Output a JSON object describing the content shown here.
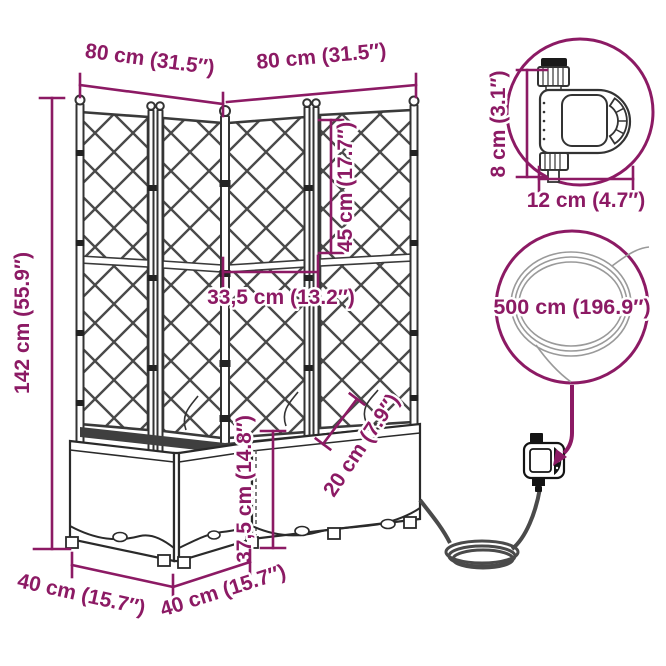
{
  "title": "Garden planter with trellis and automatic watering set — dimension diagram",
  "colors": {
    "accent": "#8C1A64",
    "line_art": "#2a2a2a",
    "hose": "#4a4a4a",
    "background": "#ffffff"
  },
  "dimensions": {
    "left_width": "80 cm (31.5″)",
    "right_width": "80 cm (31.5″)",
    "upper_trellis_height": "45 cm (17.7″)",
    "inner_span": "33,5 cm (13.2″)",
    "total_height": "142 cm (55.9″)",
    "planter_height": "37,5 cm (14.8″)",
    "rim_depth": "20 cm (7.9″)",
    "left_depth": "40 cm (15.7″)",
    "right_depth": "40 cm (15.7″)",
    "timer_height": "8 cm (3.1″)",
    "timer_width": "12 cm (4.7″)",
    "hose_length": "500 cm (196.9″)"
  }
}
